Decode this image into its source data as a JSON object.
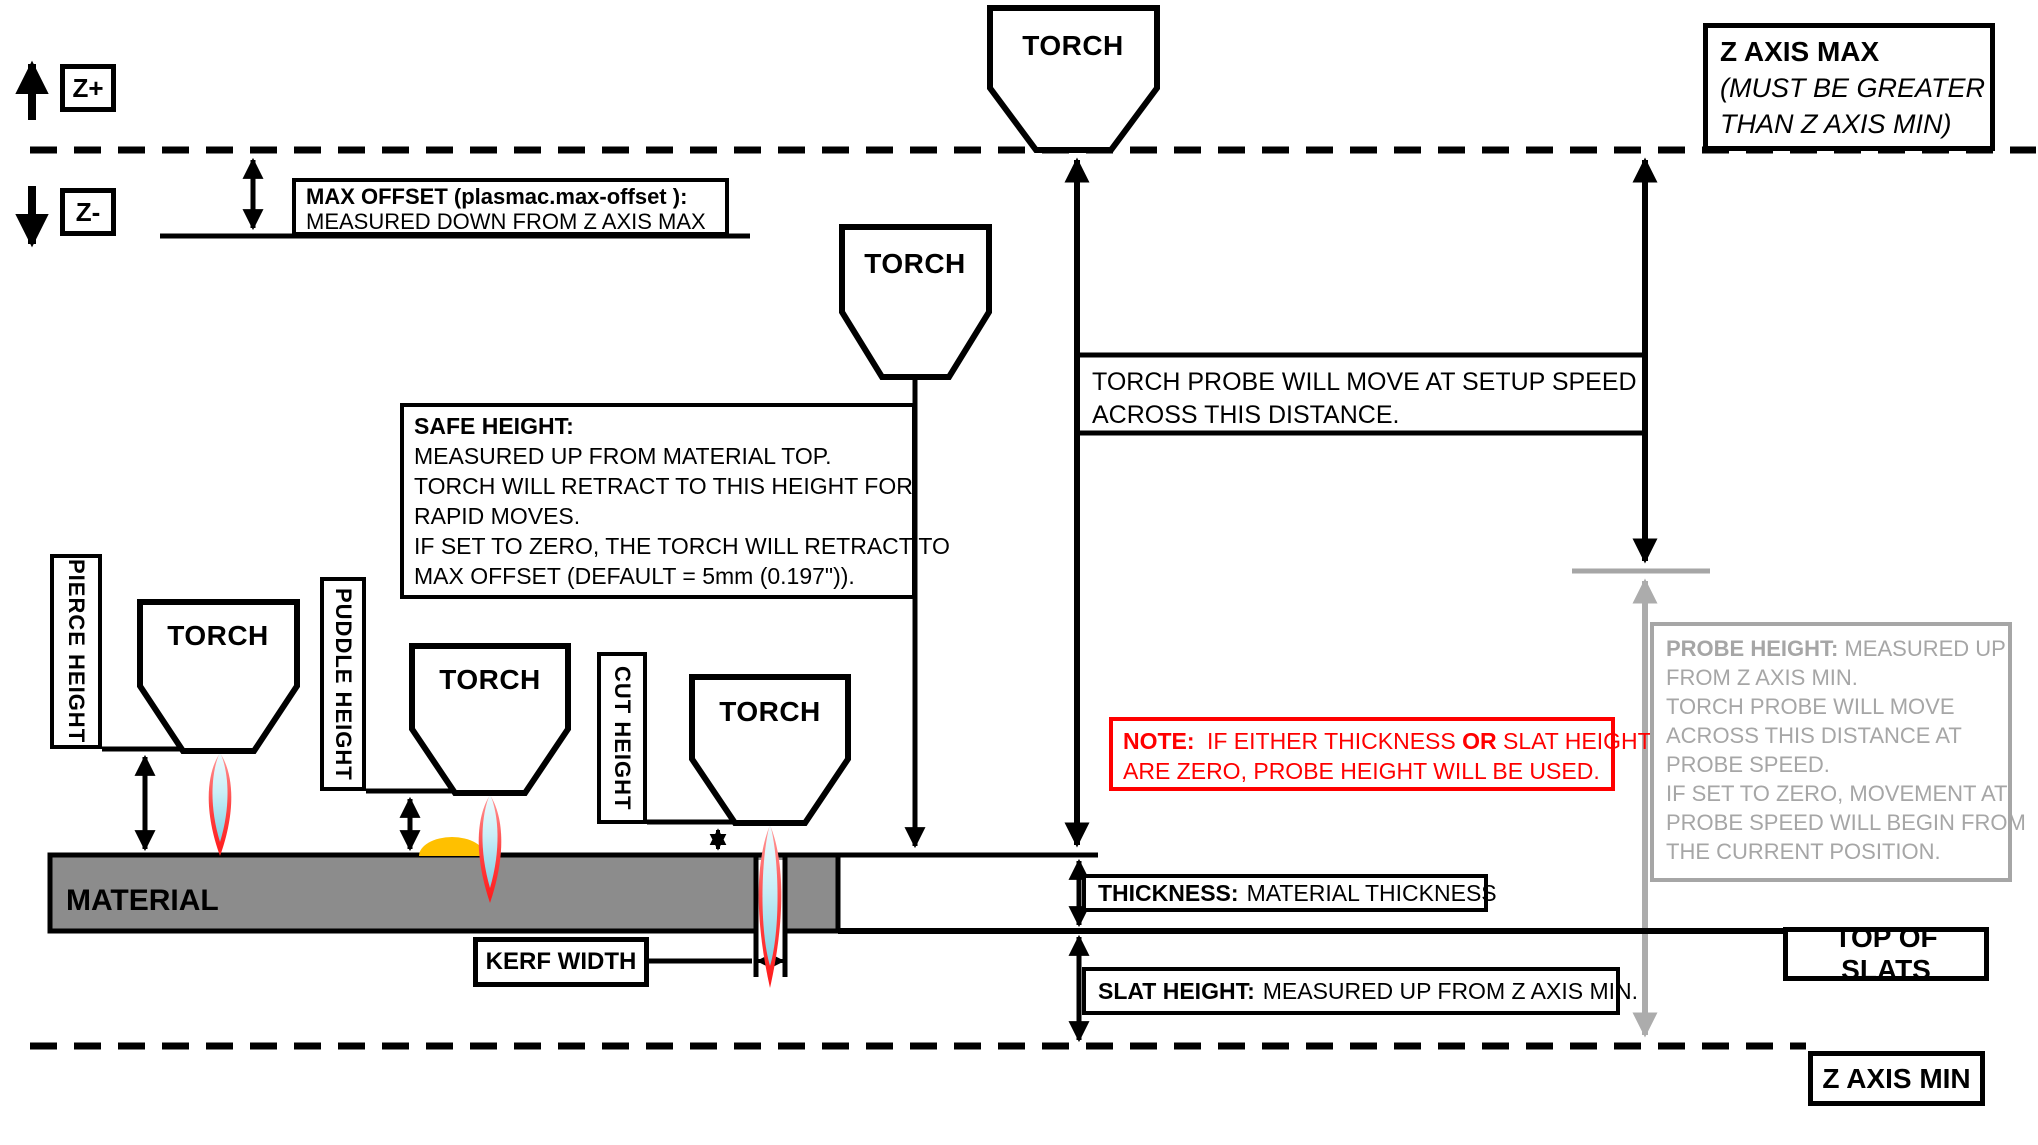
{
  "colors": {
    "note_red": "#FF0000",
    "muted_gray": "#A6A6A6",
    "gray_arrow": "#ACACAC",
    "material_gray": "#8C8C8C",
    "puddle_orange": "#FFC000",
    "flame_red": "#FF3B3B",
    "flame_core_cyan": "#C9EEF7"
  },
  "labels": {
    "torch": "TORCH",
    "z_plus": "Z+",
    "z_minus": "Z-",
    "material": "MATERIAL",
    "pierce_height": "PIERCE HEIGHT",
    "puddle_height": "PUDDLE HEIGHT",
    "cut_height": "CUT HEIGHT",
    "kerf_width": "KERF WIDTH",
    "top_of_slats": "TOP OF SLATS",
    "z_axis_min": "Z AXIS MIN"
  },
  "z_axis_max_box": {
    "title": "Z AXIS MAX",
    "note_line1": "(MUST BE GREATER",
    "note_line2": "THAN Z AXIS MIN)"
  },
  "max_offset_box": {
    "title": "MAX OFFSET (plasmac.max-offset ):",
    "body": "MEASURED DOWN FROM Z AXIS MAX"
  },
  "safe_height_box": {
    "title": "SAFE HEIGHT:",
    "lines": [
      "MEASURED UP FROM MATERIAL TOP.",
      "TORCH WILL RETRACT TO THIS HEIGHT FOR",
      "RAPID MOVES.",
      "IF SET TO ZERO, THE TORCH WILL RETRACT TO",
      "MAX OFFSET (DEFAULT = 5mm (0.197\"))."
    ]
  },
  "torch_probe_note": {
    "line1": "TORCH PROBE WILL MOVE AT SETUP SPEED",
    "line2": "ACROSS THIS DISTANCE."
  },
  "note_box": {
    "prefix": "NOTE:",
    "mid1": "IF EITHER THICKNESS",
    "bold_or": "OR",
    "mid2": "SLAT HEIGHT",
    "line2": "ARE ZERO, PROBE HEIGHT WILL BE USED."
  },
  "probe_height_box": {
    "title": "PROBE HEIGHT:",
    "title_rest": "MEASURED UP",
    "lines": [
      "FROM Z AXIS MIN.",
      "TORCH PROBE WILL MOVE",
      "ACROSS THIS DISTANCE AT",
      "PROBE SPEED.",
      "IF SET TO ZERO,  MOVEMENT AT",
      "PROBE SPEED WILL BEGIN FROM",
      "THE CURRENT POSITION."
    ]
  },
  "thickness_box": {
    "title": "THICKNESS:",
    "body": "MATERIAL THICKNESS"
  },
  "slat_height_box": {
    "title": "SLAT HEIGHT:",
    "body": "MEASURED UP FROM Z AXIS MIN."
  }
}
